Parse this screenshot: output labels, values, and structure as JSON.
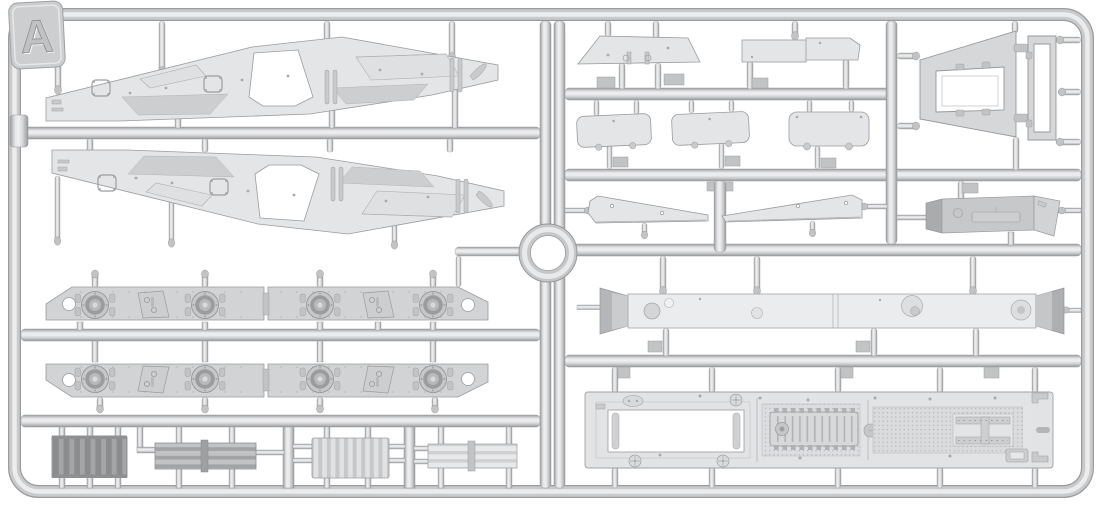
{
  "meta": {
    "type": "model-kit-sprue-photo",
    "description": "Injection-molded plastic model kit sprue, frame letter A, light grey styrene parts on white background"
  },
  "sprue": {
    "letter": "A"
  },
  "colors": {
    "background": "#ffffff",
    "runner_base": "#c9cacc",
    "runner_highlight": "#ececed",
    "runner_shadow": "#9b9c9e",
    "part_light": "#e4e5e7",
    "part_mid": "#d2d3d5",
    "part_dark": "#a9aaac",
    "radiator_dark": "#8b8c8e",
    "outline": "#9a9b9d",
    "hole": "#ffffff"
  },
  "parts": {
    "groups": [
      {
        "id": "sprue-letter-tab"
      },
      {
        "id": "outer-frame"
      },
      {
        "id": "runner-grid"
      },
      {
        "id": "center-ring"
      },
      {
        "id": "fender-panel-upper"
      },
      {
        "id": "fender-panel-lower"
      },
      {
        "id": "suspension-strip-row-1"
      },
      {
        "id": "suspension-strip-row-2"
      },
      {
        "id": "radiator-dark"
      },
      {
        "id": "louver-panel-mid"
      },
      {
        "id": "radiator-light"
      },
      {
        "id": "louver-panel-light"
      },
      {
        "id": "trapezoid-hatch-plate"
      },
      {
        "id": "roof-plate-pair"
      },
      {
        "id": "hatch-panel-1"
      },
      {
        "id": "hatch-panel-2"
      },
      {
        "id": "hatch-panel-3"
      },
      {
        "id": "fender-blade-left"
      },
      {
        "id": "fender-blade-right"
      },
      {
        "id": "engine-hatch-frame"
      },
      {
        "id": "narrow-hatch-frame"
      },
      {
        "id": "stowage-box"
      },
      {
        "id": "hull-belly-beam"
      },
      {
        "id": "hull-floor-plate"
      }
    ]
  }
}
